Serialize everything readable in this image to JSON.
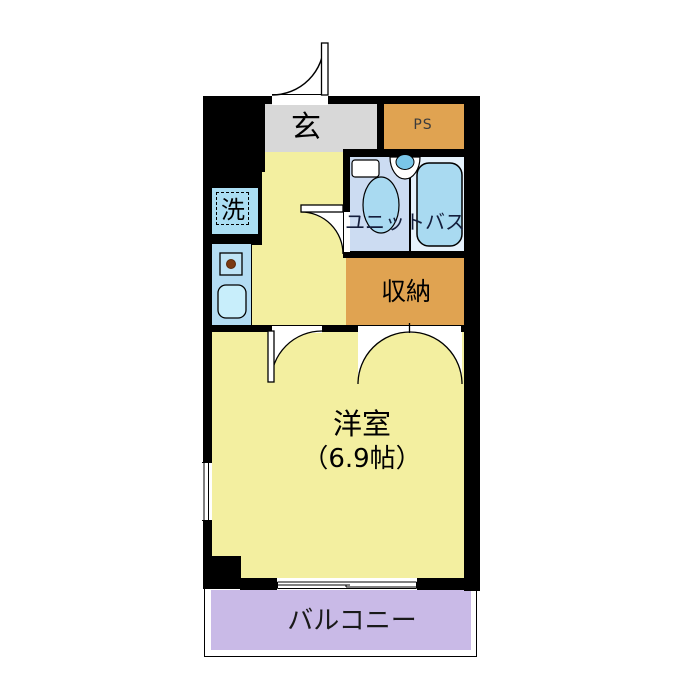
{
  "rooms": {
    "entrance": {
      "label": "玄"
    },
    "pipe_space": {
      "label": "PS"
    },
    "unit_bath": {
      "label": "ユニットバス"
    },
    "storage": {
      "label": "収納"
    },
    "laundry": {
      "label": "洗"
    },
    "main_room": {
      "label": "洋室",
      "size": "（6.9帖）"
    },
    "balcony": {
      "label": "バルコニー"
    }
  },
  "colors": {
    "floor_yellow": "#f3efa0",
    "entrance_gray": "#d8d8d8",
    "service_orange": "#e0a351",
    "bath_blue_left": "#ccdcf2",
    "bath_blue_right": "#e6f2fc",
    "fixture_blue": "#a9daf1",
    "kitchen_blue": "#b3dcf3",
    "laundry_blue": "#abdef3",
    "sink_blue": "#c8eefb",
    "balcony_purple": "#c9bae7",
    "wall_black": "#000000"
  }
}
